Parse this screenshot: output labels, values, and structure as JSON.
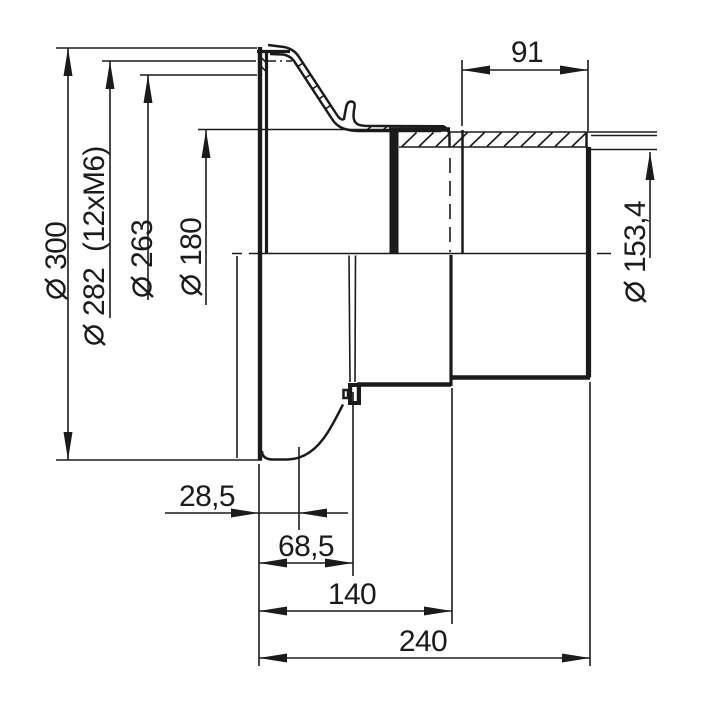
{
  "drawing": {
    "kind": "mechanical-engineering-half-section-drawing",
    "units": "mm",
    "background_color": "#ffffff",
    "line_color": "#1b1b1b",
    "diameter_symbol": "⌀",
    "dims": {
      "dia300": {
        "prefix": "⌀",
        "value": "300"
      },
      "dia282": {
        "prefix": "⌀",
        "value": "282",
        "note": "(12xM6)"
      },
      "dia263": {
        "prefix": "⌀",
        "value": "263"
      },
      "dia180": {
        "prefix": "⌀",
        "value": "180"
      },
      "dia153_4": {
        "prefix": "⌀",
        "value": "153,4"
      },
      "len91": {
        "value": "91"
      },
      "len28_5": {
        "value": "28,5"
      },
      "len68_5": {
        "value": "68,5"
      },
      "len140": {
        "value": "140"
      },
      "len240": {
        "value": "240"
      }
    }
  }
}
